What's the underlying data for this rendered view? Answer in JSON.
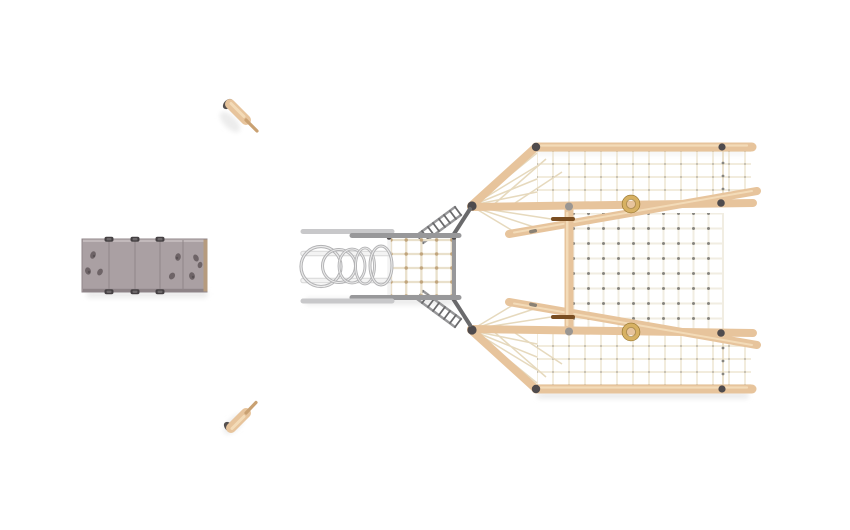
{
  "canvas": {
    "width": 850,
    "height": 530
  },
  "colors": {
    "background": "#ffffff",
    "shadow": "#ececec",
    "wood": "#e7c49c",
    "wood_dark": "#c9a172",
    "wood_hi": "#f4dfbd",
    "metal": "#98989a",
    "metal_dark": "#6a6a6c",
    "metal_light": "#c8c8ca",
    "white_rail": "#f3f3f3",
    "rope_cream": "#e6d9bd",
    "rope_pale": "#f1ede2",
    "rope_wing": "#eee5d2",
    "rope_deck": "#e9e0cb",
    "knot": "#87857f",
    "knot_tan": "#c0a47c",
    "wall_panel_c": "#aaa0a3",
    "wall_edge_c": "#90868a",
    "wall_trim_c": "#b69b7e",
    "hold_c": "#6e6467",
    "cap_c": "#454043",
    "gold": "#d7b163",
    "gold_dark": "#94742f",
    "clamp": "#4f4b4d",
    "pole_brown": "#7a4e22"
  },
  "scene": {
    "view": "top-down",
    "items": [
      {
        "id": "climbing-wall",
        "label": "climbing wall panel",
        "panels": 4,
        "holds": 8,
        "post_caps": 6
      },
      {
        "id": "stepping-post-top",
        "label": "wooden stepping post"
      },
      {
        "id": "stepping-post-bottom",
        "label": "wooden stepping post"
      },
      {
        "id": "climbing-structure",
        "label": "rope climbing structure",
        "parts": [
          "crawl-rings",
          "bridge-rails",
          "net-deck",
          "access-ladder-upper",
          "access-ladder-lower",
          "rope-wing-upper",
          "rope-wing-lower",
          "central-net",
          "timber-beams",
          "gold-rings"
        ],
        "crawl_rings": 5,
        "gold_rings": 2
      }
    ]
  }
}
